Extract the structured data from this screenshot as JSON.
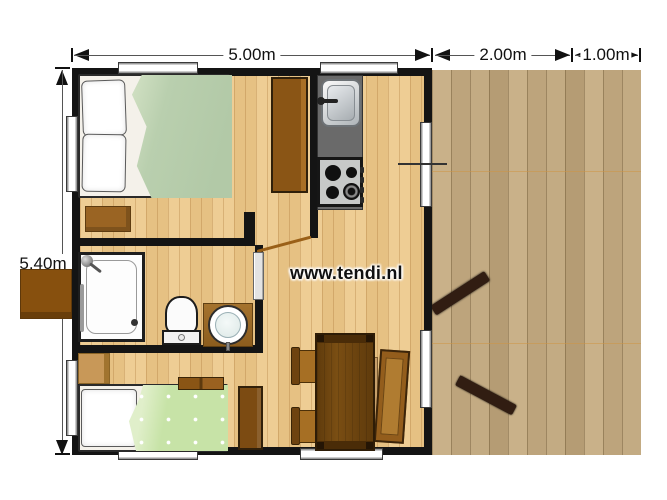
{
  "page": {
    "website": "www.tendi.nl"
  },
  "dimensions": {
    "cabin_width": "5.00m",
    "terrace_depth": "2.00m",
    "terrace_extension": "1.00m",
    "cabin_height": "5.40m"
  },
  "colors": {
    "wall": "#141414",
    "interior_floor": "#eac588",
    "deck_wood": "#c3ab83",
    "double_duvet": "#b9cfae",
    "single_duvet": "#c7e3a7",
    "furniture_brown": "#8a5515",
    "counter_gray": "#6a6a6a",
    "dimension_text": "#111111"
  }
}
